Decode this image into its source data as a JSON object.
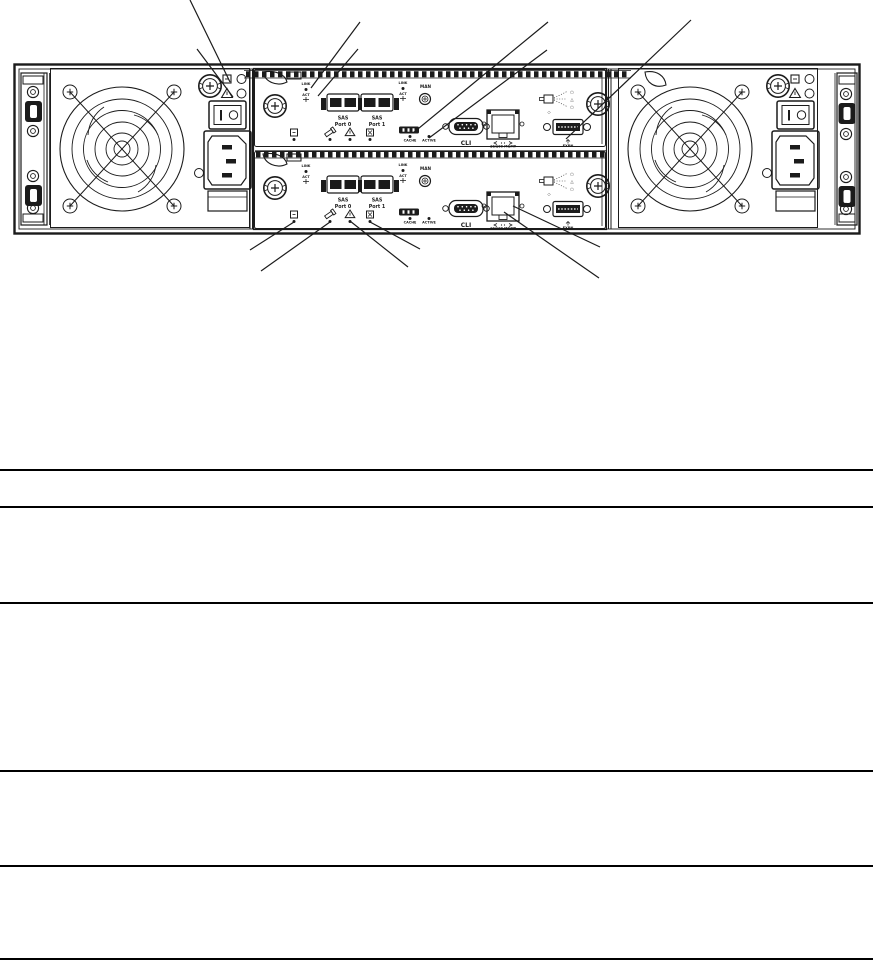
{
  "colors": {
    "line": "#1b1b1b",
    "background": "#ffffff"
  },
  "diagram": {
    "labels": {
      "link": "LINK",
      "act": "ACT",
      "sas": "SAS",
      "port0": "Port 0",
      "port1": "Port 1",
      "man": "MAN",
      "cache": "CACHE",
      "active": "ACTIVE",
      "cli": "CLI",
      "mgmt": "10/100 MGMT",
      "exp": "EXPN"
    },
    "legend_glyphs": {
      "top": "○",
      "middle": "△",
      "bottom": "○",
      "diamond": "◇"
    },
    "icons": {
      "psu_ok_led_icon": "square",
      "psu_fault_led_icon": "warning-triangle",
      "ok_led_icon": "square-dot",
      "locate_led_icon": "flashlight",
      "fault_led_icon": "warning-triangle",
      "ok_to_remove_led_icon": "boxed-cross",
      "cache_status_badge": "black-badge",
      "ethernet_arrows_icon": "left-right-arrows",
      "exp_arrow_icon": "up-arrow"
    }
  }
}
